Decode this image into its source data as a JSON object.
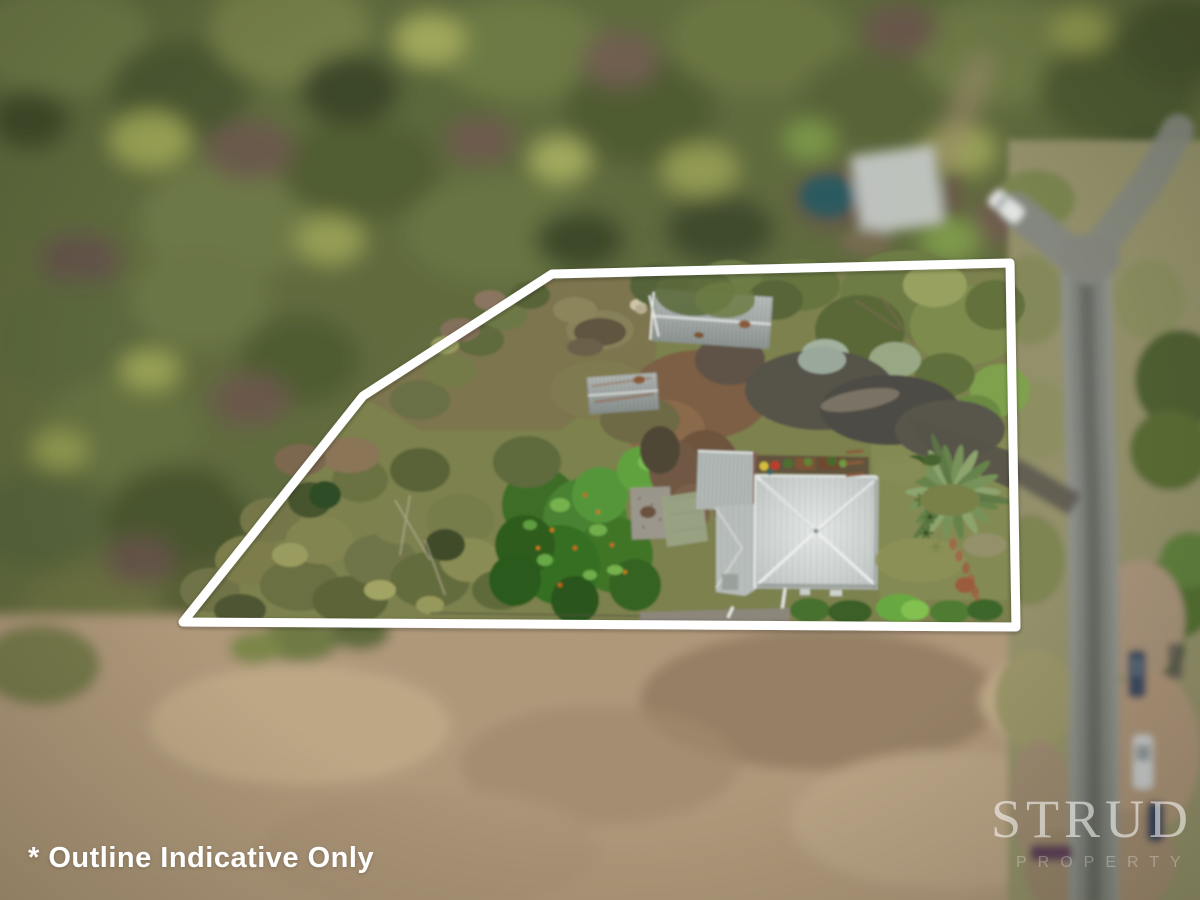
{
  "annotation": {
    "text": "* Outline Indicative Only"
  },
  "watermark": {
    "brand": "STRUD",
    "subtitle": "PROPERTY"
  },
  "outline": {
    "points": "552,274 1010,263 1016,627 183,622 363,396",
    "color": "#ffffff",
    "note": "white boundary overlay"
  },
  "scene": {
    "palette": {
      "outline": "#ffffff",
      "text": "#ffffff",
      "forestDark": "#4a5530",
      "forestOlive": "#5f6a3c",
      "fieldTan": "#b19a7d",
      "roadGray": "#7f827b",
      "roofLight": "#d2d7d5",
      "shedGray": "#a2a9a6",
      "gravelBrown": "#6f5a45",
      "treeGreen": "#3f7527",
      "lawnOlive": "#7c814e"
    }
  }
}
